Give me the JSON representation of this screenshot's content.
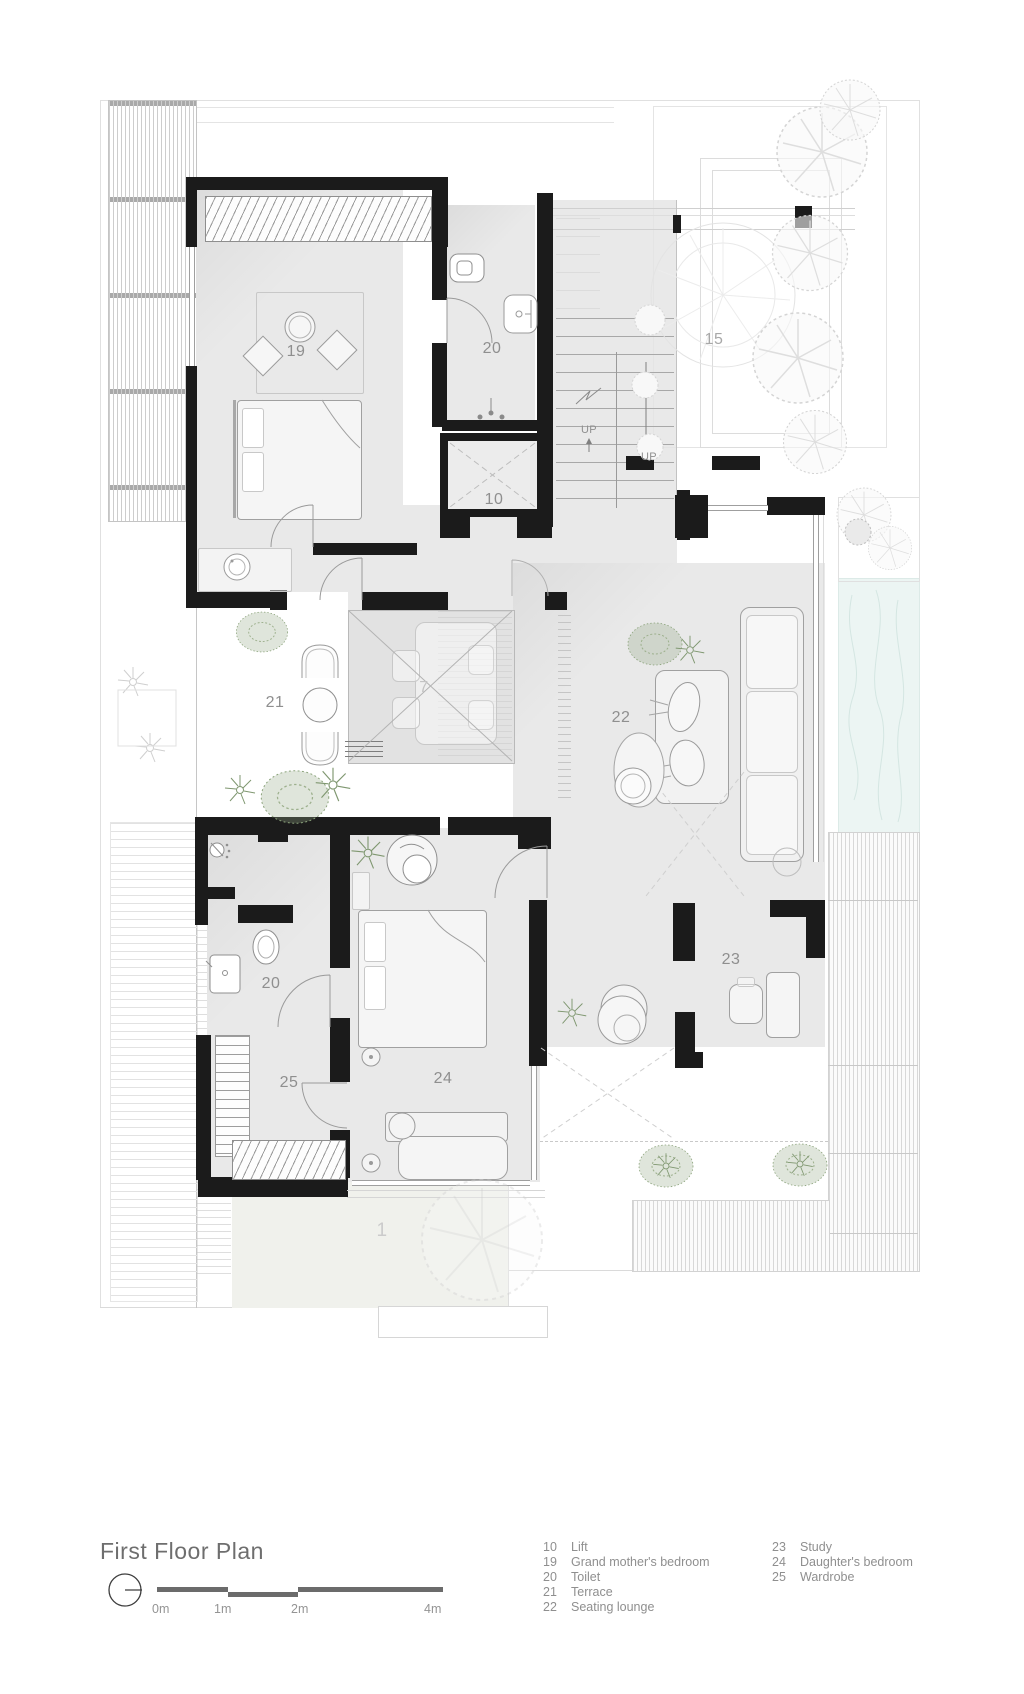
{
  "title": "First Floor Plan",
  "scale_bar": {
    "labels": [
      "0m",
      "1m",
      "2m",
      "4m"
    ]
  },
  "legend": {
    "columns": [
      {
        "items": [
          {
            "num": "10",
            "label": "Lift"
          },
          {
            "num": "19",
            "label": "Grand mother's bedroom"
          },
          {
            "num": "20",
            "label": "Toilet"
          },
          {
            "num": "21",
            "label": "Terrace"
          },
          {
            "num": "22",
            "label": "Seating lounge"
          }
        ]
      },
      {
        "items": [
          {
            "num": "23",
            "label": "Study"
          },
          {
            "num": "24",
            "label": "Daughter's bedroom"
          },
          {
            "num": "25",
            "label": "Wardrobe"
          }
        ]
      }
    ]
  },
  "plan_labels": {
    "grandmother_bedroom": "19",
    "toilet_upper": "20",
    "lift": "10",
    "roof_garden": "15",
    "terrace": "21",
    "double_height_void": "7",
    "seating_lounge": "22",
    "toilet_lower": "20",
    "wardrobe": "25",
    "daughters_bedroom": "24",
    "study": "23",
    "ground_floor_below": "1",
    "stairs_up_a": "UP",
    "stairs_up_b": "UP"
  },
  "colors": {
    "wall": "#1b1b1b",
    "room_floor": "#e9e9e9",
    "pool": "#ecf5f3",
    "plant_green": "#8ba37b",
    "label_gray": "#8f8f8f"
  }
}
